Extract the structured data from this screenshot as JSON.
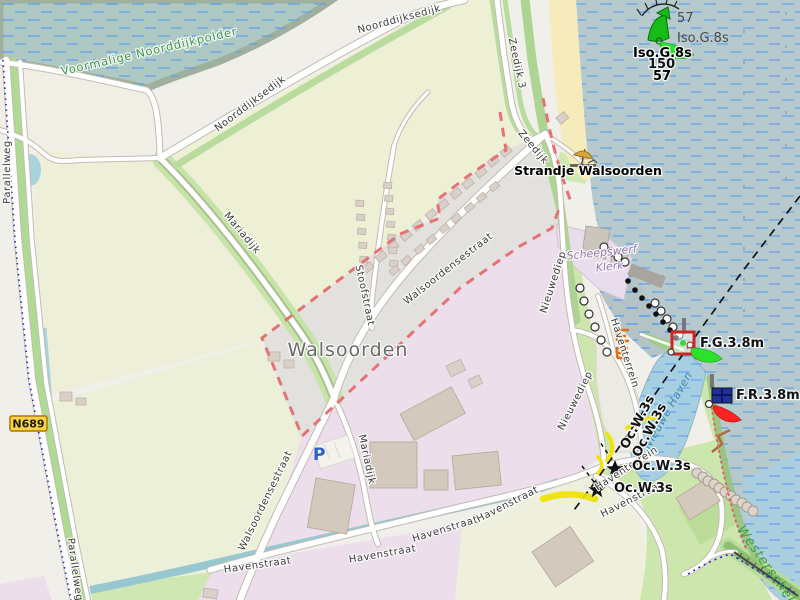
{
  "map": {
    "place_labels": {
      "village": "Walsoorden",
      "polder": "Voormalige Noorddijkpolder",
      "beach": "Strandje Walsoorden",
      "shipyard_line1": "Scheepswerf",
      "shipyard_line2": "Klerk",
      "harbor_basin": "Nieuwe Haven",
      "estuary": "Westerschelde"
    },
    "road_labels": {
      "noorddijksedijk": "Noorddijksedijk",
      "zeedijk_3": "Zeedijk 3",
      "zeedijk": "Zeedijk",
      "parallelweg": "Parallelweg",
      "mariadijk": "Mariadijk",
      "stoofstraat": "Stoofstraat",
      "walsoordensestraat": "Walsoordensestraat",
      "havenstraat": "Havenstraat",
      "nieuwediep": "Nieuwediep",
      "haventerrein": "Haventerrein"
    },
    "route_badge": {
      "ref": "N689"
    },
    "parking_symbol": "P",
    "seamarks": {
      "buoy_number": "57",
      "buoy_light_character": "Iso.G.8s",
      "buoy_number_bold": "57",
      "buoy_light_character_bold": "Iso.G.8s",
      "overlapping_number": "150",
      "fixed_green_light": "F.G.3.8m",
      "fixed_red_light": "F.R.3.8m",
      "occulting_light": "Oc.W.3s"
    },
    "colors": {
      "sea": "#b6cacd",
      "harbor_water": "#a6cfe1",
      "marsh": "#aec8c4",
      "farmland": "#eef0d6",
      "grass": "#cde6ae",
      "residential": "#e3e1dd",
      "industrial": "#ecdeeb",
      "building": "#d9d0c9",
      "boundary_red": "#e57373",
      "green_light_flare": "#2be22b",
      "red_light_flare": "#ff2222",
      "yellow_light_flare": "#f2e200"
    }
  }
}
